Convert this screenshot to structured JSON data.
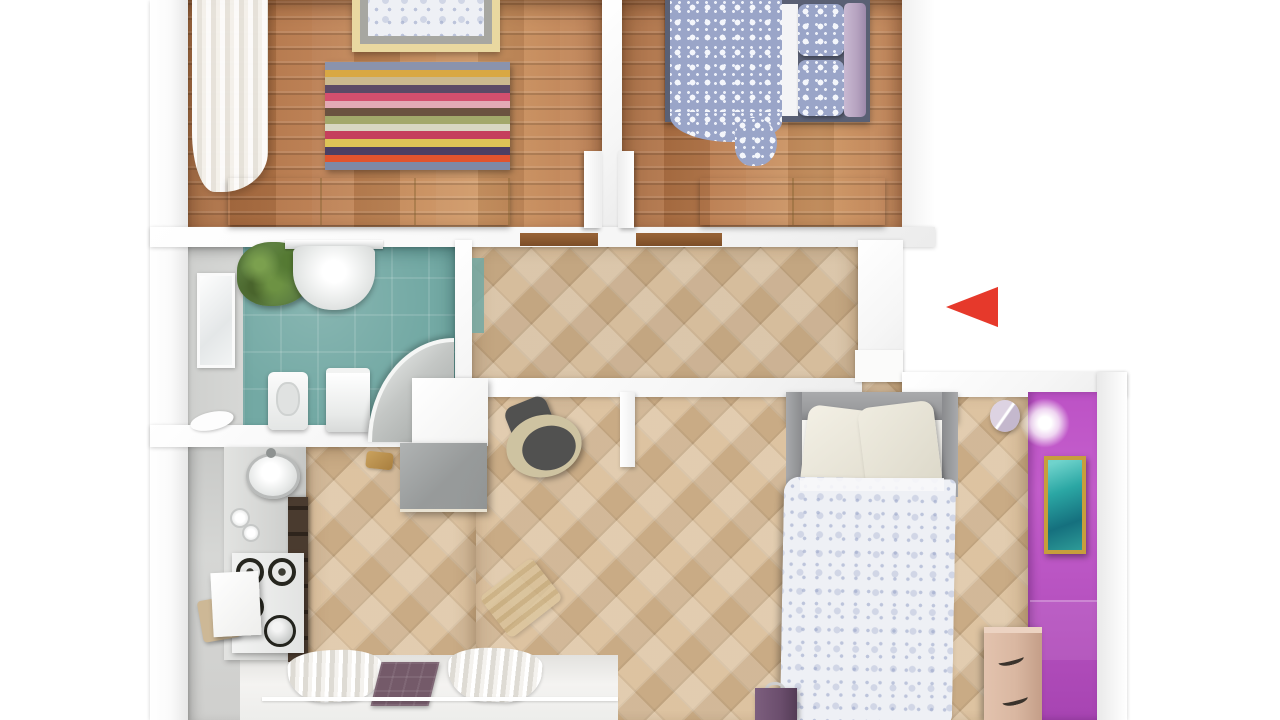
{
  "scene": {
    "type": "3d-floor-plan-top-view",
    "regions": [
      {
        "id": "bedroom-left",
        "floor": "oak-planks",
        "furniture": [
          "bed",
          "striped-rug",
          "bench",
          "curtain"
        ]
      },
      {
        "id": "bedroom-right",
        "floor": "oak-planks",
        "furniture": [
          "double-bed",
          "bench"
        ]
      },
      {
        "id": "bathroom",
        "floor": "teal-tiles",
        "furniture": [
          "sink",
          "toilet",
          "washing-machine",
          "corner-shower",
          "plant",
          "window"
        ]
      },
      {
        "id": "hallway",
        "floor": "diagonal-parquet",
        "furniture": []
      },
      {
        "id": "kitchen",
        "floor": "gray-linoleum",
        "furniture": [
          "counter",
          "round-sink",
          "gas-stove",
          "table",
          "chair",
          "tall-cabinet"
        ]
      },
      {
        "id": "living-bedroom",
        "floor": "diagonal-parquet",
        "furniture": [
          "double-bed",
          "wardrobe",
          "armchair",
          "dresser",
          "stool",
          "painting",
          "wall-lights",
          "purple-accent-wall"
        ]
      }
    ]
  },
  "nav": {
    "arrow": {
      "direction": "left",
      "color": "#e6392b"
    }
  },
  "rug": {
    "stripes": [
      "#8a93ad",
      "#d9a843",
      "#cbb98f",
      "#5c4a66",
      "#d44f6e",
      "#e3aab5",
      "#6b5240",
      "#a3a86b",
      "#d8d7c2",
      "#c53f5c",
      "#ddc457",
      "#4b3f63",
      "#e0542e",
      "#7d89a6"
    ]
  },
  "palette": {
    "arrow_red": "#e6392b",
    "wood_base": "#b97a4c",
    "wood_light": "#cf9764",
    "wood_dark": "#a5683c",
    "parquet_base": "#d9bc96",
    "teal_floor": "#73a9a4",
    "kitchen_floor": "#cdcecd",
    "purple_wall": "#bc52c5",
    "purple_wall_dark": "#a744b2",
    "bench_wood": "#e9d8a0",
    "bed2_frame": "#5a6074",
    "floral_blue": "#9aa5c8",
    "mauve": "#b5a2bf",
    "headboard_gray": "#9a9b9d",
    "painting_teal": "#2ba7a4",
    "frame_gold": "#c79e3c",
    "dresser_pink": "#d9b7a1",
    "stool_purple": "#6b4e6d",
    "plant_green": "#5f8142",
    "shower_gray": "#c4c7c5",
    "wardrobe_gray": "#979a9a",
    "armchair_dark": "#515150",
    "armchair_rim": "#cec3a1",
    "mat_plum": "#745a69"
  }
}
